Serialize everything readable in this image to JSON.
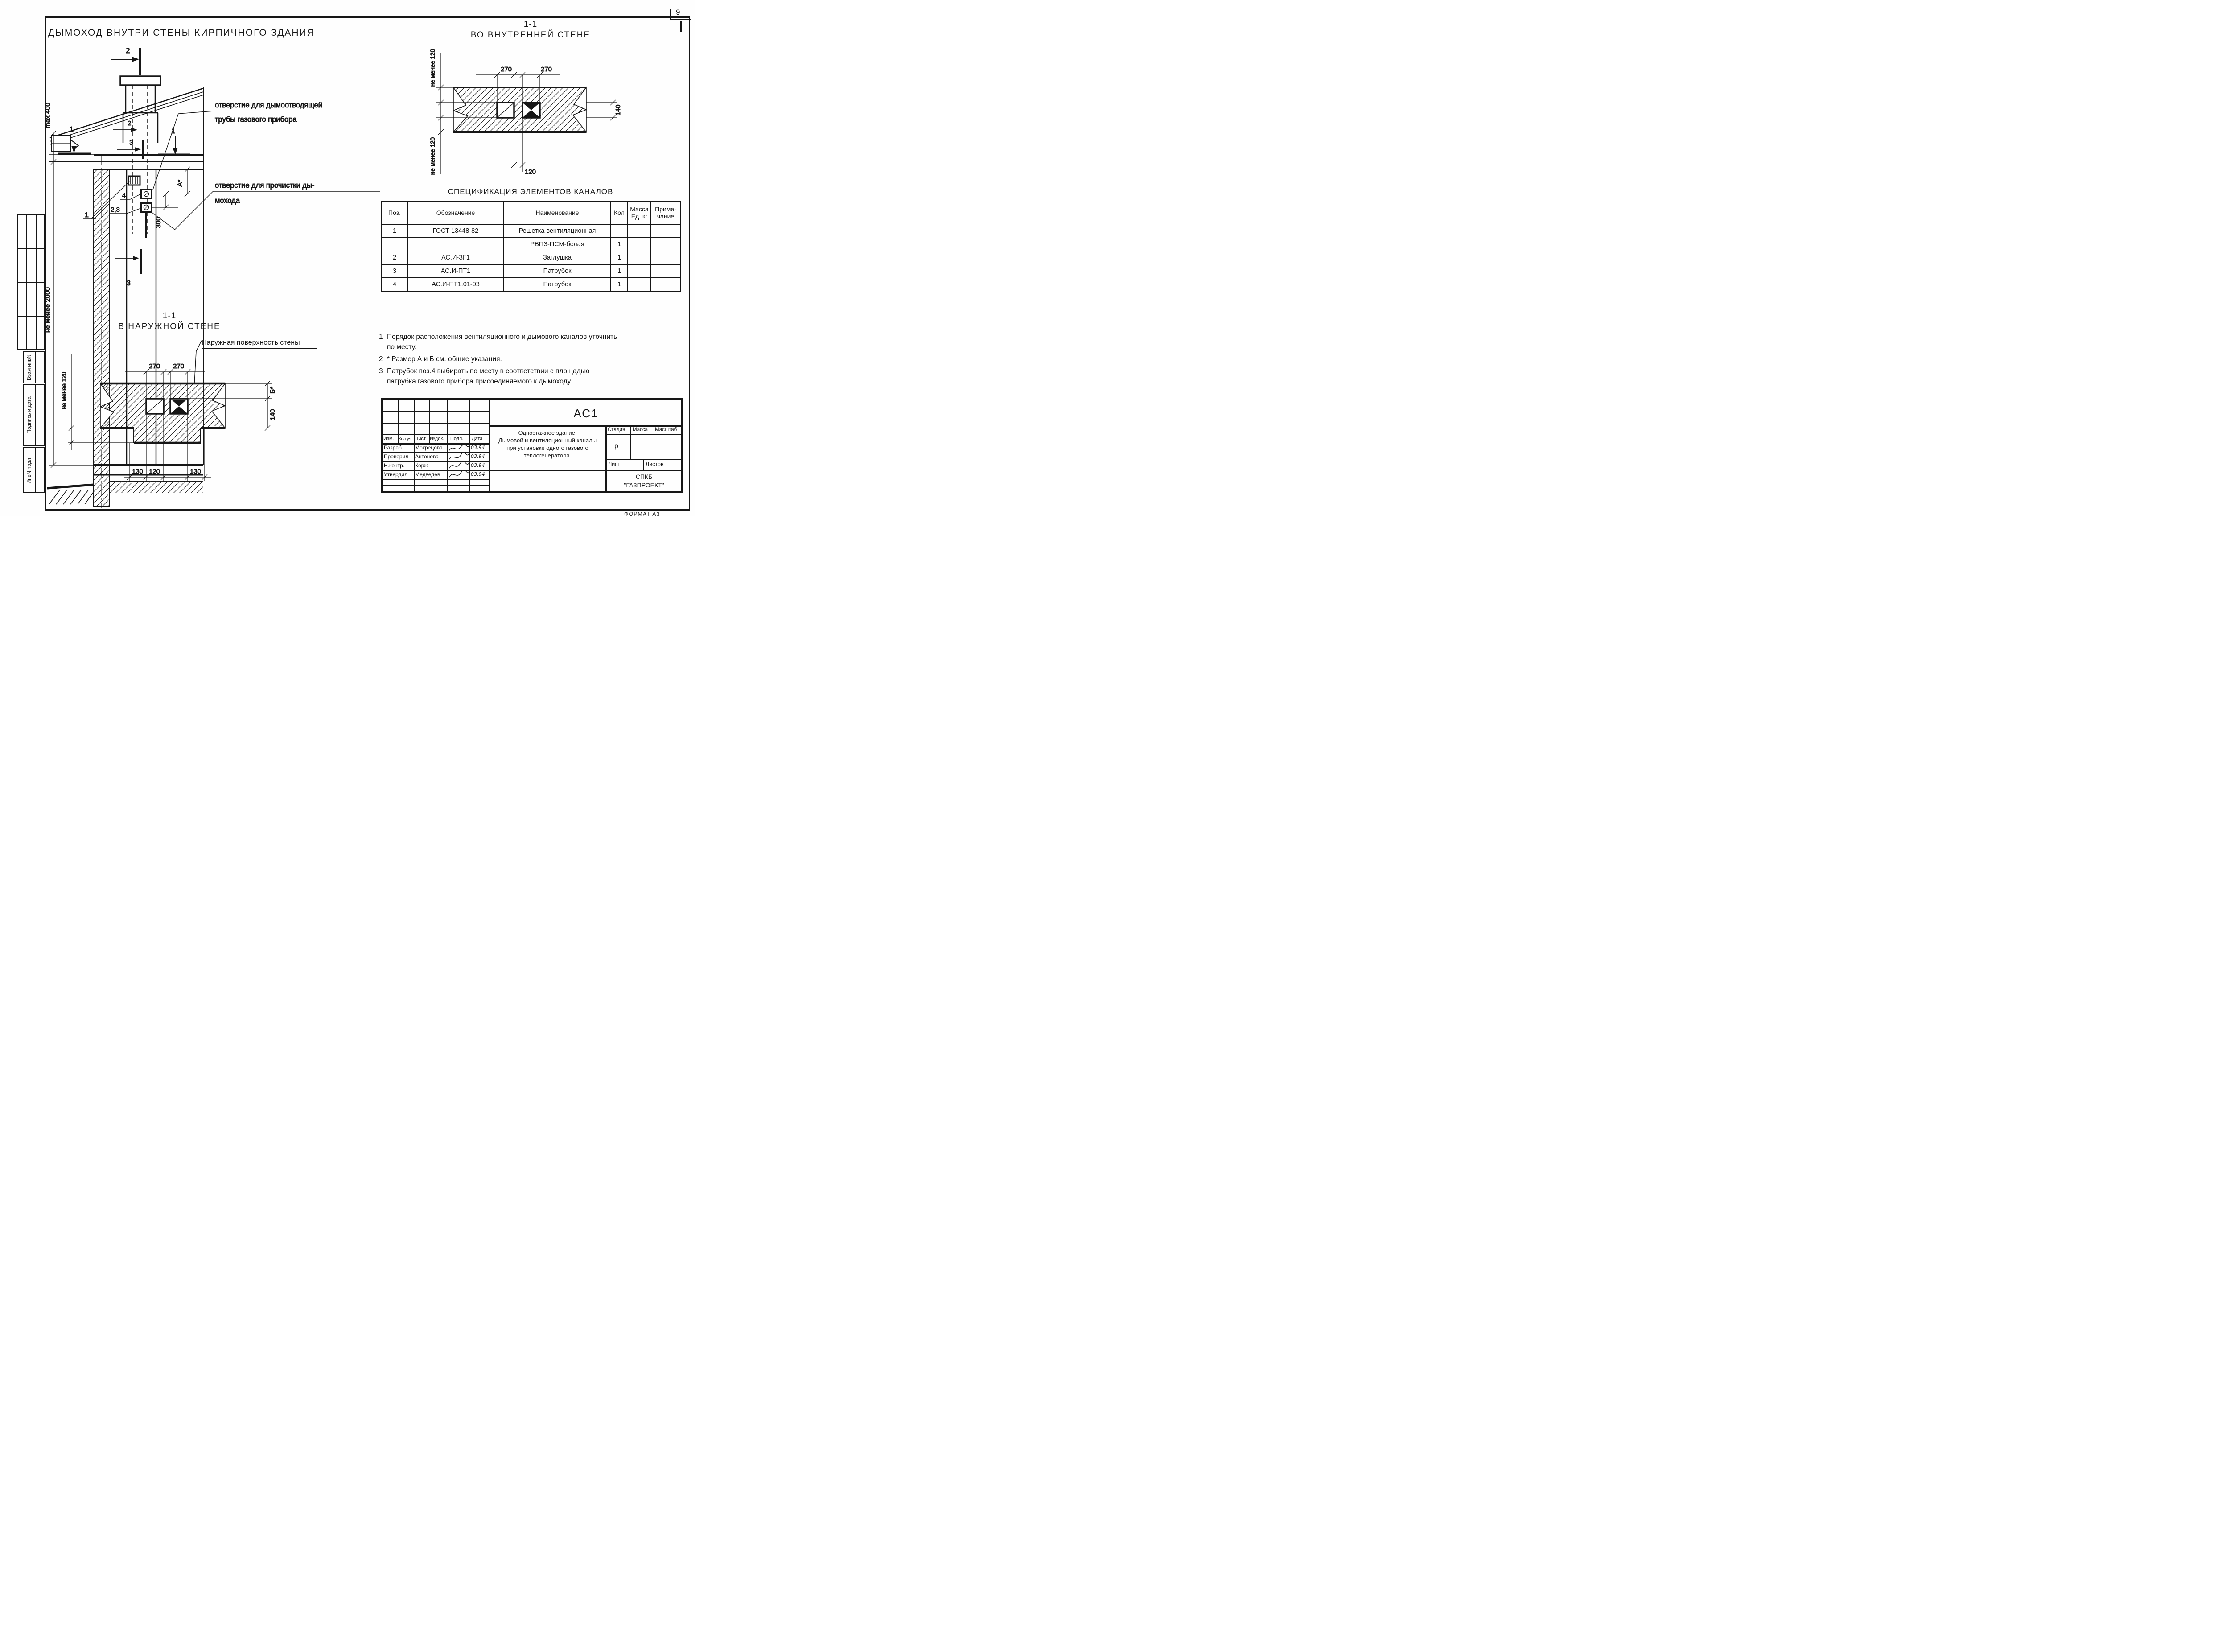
{
  "sheet": {
    "page_number": "9",
    "format_label": "ФОРМАТ А3"
  },
  "main_view": {
    "title": "ДЫМОХОД ВНУТРИ СТЕНЫ КИРПИЧНОГО ЗДАНИЯ",
    "callout_flue_1": "отверстие для дымоотводящей",
    "callout_flue_2": "трубы газового прибора",
    "callout_clean_1": "отверстие для прочистки ды-",
    "callout_clean_2": "мохода",
    "dim_max400": "max 400",
    "dim_min2000": "не менее 2000",
    "dim_300": "300",
    "dim_A": "А*",
    "mark_1L": "1",
    "mark_1R": "1",
    "mark_2_top": "2",
    "mark_2_low": "2",
    "mark_3_top": "3",
    "mark_3_low": "3",
    "pos_1": "1",
    "pos_4": "4",
    "pos_23": "2,3"
  },
  "inner_view": {
    "title1": "1-1",
    "title2": "ВО ВНУТРЕННЕЙ СТЕНЕ",
    "dim_270l": "270",
    "dim_270r": "270",
    "dim_120": "120",
    "dim_140": "140",
    "dim_min120_top": "не менее 120",
    "dim_min120_bot": "не менее 120"
  },
  "outer_view": {
    "title1": "1-1",
    "title2": "В НАРУЖНОЙ СТЕНЕ",
    "surface_label": "Наружная поверхность стены",
    "dim_270l": "270",
    "dim_270r": "270",
    "dim_130l": "130",
    "dim_120": "120",
    "dim_130r": "130",
    "dim_min120": "не менее 120",
    "dim_B": "Б*",
    "dim_140": "140"
  },
  "spec": {
    "title": "СПЕЦИФИКАЦИЯ ЭЛЕМЕНТОВ КАНАЛОВ",
    "h_pos": "Поз.",
    "h_des": "Обозначение",
    "h_name": "Наименование",
    "h_qty": "Кол",
    "h_mass1": "Масса",
    "h_mass2": "Ед, кг",
    "h_note1": "Приме-",
    "h_note2": "чание",
    "rows": [
      {
        "pos": "1",
        "des": "ГОСТ 13448-82",
        "name": "Решетка вентиляционная",
        "qty": "",
        "mass": "",
        "note": ""
      },
      {
        "pos": "",
        "des": "",
        "name": "РВПЗ-ПСМ-белая",
        "qty": "1",
        "mass": "",
        "note": ""
      },
      {
        "pos": "2",
        "des": "АС.И-ЗГ1",
        "name": "Заглушка",
        "qty": "1",
        "mass": "",
        "note": ""
      },
      {
        "pos": "3",
        "des": "АС.И-ПТ1",
        "name": "Патрубок",
        "qty": "1",
        "mass": "",
        "note": ""
      },
      {
        "pos": "4",
        "des": "АС.И-ПТ1.01-03",
        "name": "Патрубок",
        "qty": "1",
        "mass": "",
        "note": ""
      }
    ]
  },
  "notes": {
    "n1": "1",
    "n1_l1": "Порядок расположения вентиляционного и дымового каналов уточнить",
    "n1_l2": "по месту.",
    "n2": "2",
    "n2_l1": "* Размер А и Б см. общие указания.",
    "n3": "3",
    "n3_l1": "Патрубок поз.4 выбирать по месту в соответствии с площадью",
    "n3_l2": "патрубка газового прибора присоединяемого к дымоходу."
  },
  "titleblock": {
    "code": "АС1",
    "h_izm": "Изм.",
    "h_koluch": "Кол.уч.",
    "h_list": "Лист",
    "h_ndok": "№док.",
    "h_podp": "Подп.",
    "h_data": "Дата",
    "r1_role": "Разраб.",
    "r1_name": "Мокрецова",
    "r1_date": "03.94",
    "r2_role": "Проверил",
    "r2_name": "Антонова",
    "r2_date": "03.94",
    "r3_role": "Н.контр.",
    "r3_name": "Корж",
    "r3_date": "03.94",
    "r4_role": "Утвердил",
    "r4_name": "Медведев",
    "r4_date": "03.94",
    "desc1": "Одноэтажное здание.",
    "desc2": "Дымовой и вентиляционный каналы",
    "desc3": "при установке одного газового",
    "desc4": "теплогенератора.",
    "h_stage": "Стадия",
    "h_mass": "Масса",
    "h_scale": "Масштаб",
    "stage": "р",
    "h_sheet": "Лист",
    "h_sheets": "Листов",
    "org1": "СПКБ",
    "org2": "\"ГАЗПРОЕКТ\""
  },
  "sidebar": {
    "l1": "Взам инвN",
    "l2": "Подпись и дата",
    "l3": "ИнвN подл."
  }
}
